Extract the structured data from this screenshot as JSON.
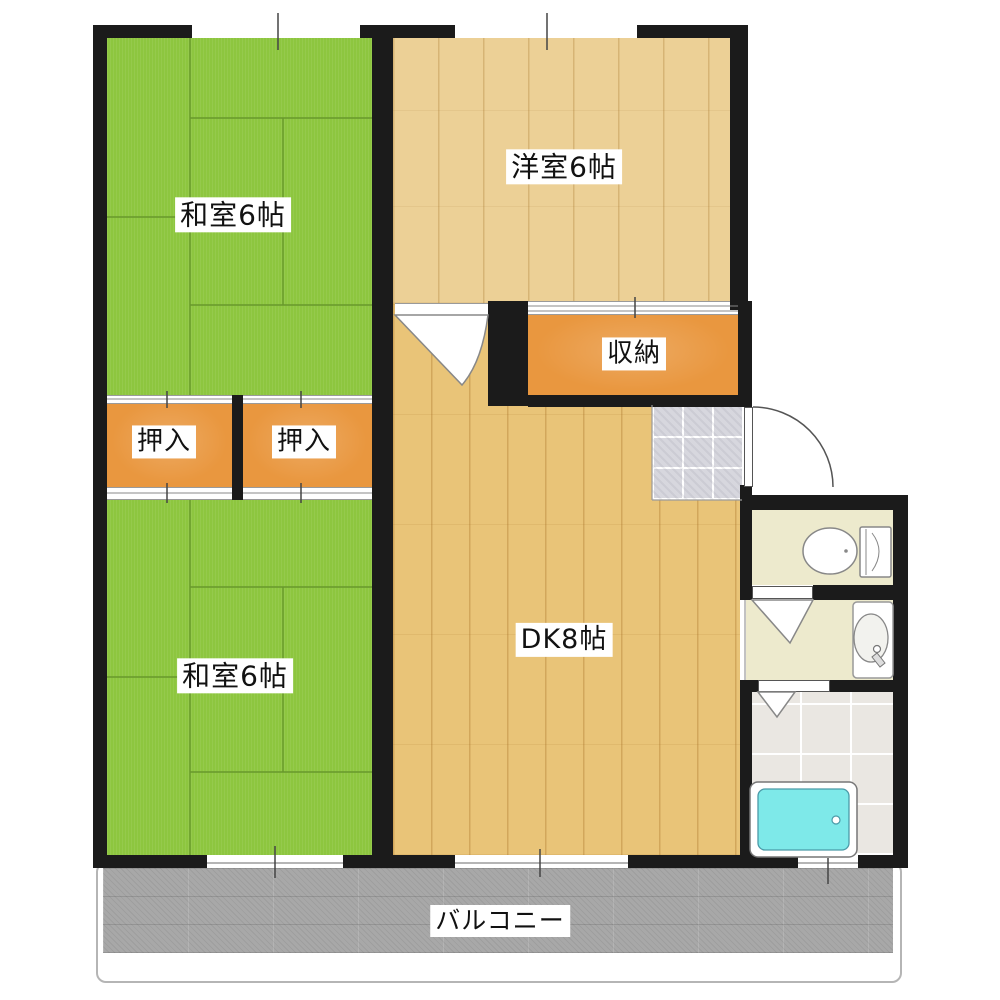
{
  "plan": {
    "title": "2DK apartment floor plan",
    "rooms": [
      {
        "id": "washitsu-top",
        "label": "和室6帖"
      },
      {
        "id": "yoshitsu",
        "label": "洋室6帖"
      },
      {
        "id": "shuno",
        "label": "収納"
      },
      {
        "id": "oshiire-left",
        "label": "押入"
      },
      {
        "id": "oshiire-right",
        "label": "押入"
      },
      {
        "id": "washitsu-bottom",
        "label": "和室6帖"
      },
      {
        "id": "dk",
        "label": "DK8帖"
      },
      {
        "id": "balcony",
        "label": "バルコニー"
      }
    ],
    "fixtures": [
      "entrance-door",
      "toilet",
      "washbasin",
      "bathtub",
      "genkan-tile"
    ],
    "colors": {
      "wall": "#1b1b1b",
      "tatami": "#8dc63f",
      "tatami-line": "#68982c",
      "wood-light": "#ecd096",
      "wood-dk": "#e9c478",
      "closet-orange": "#e9973f",
      "sanitary-cream": "#edeacd",
      "bath-tile": "#eae7e2",
      "genkan-tile": "#d7d7de",
      "balcony-gray": "#a8a8a8",
      "tub-cyan": "#7ee9e9"
    }
  }
}
